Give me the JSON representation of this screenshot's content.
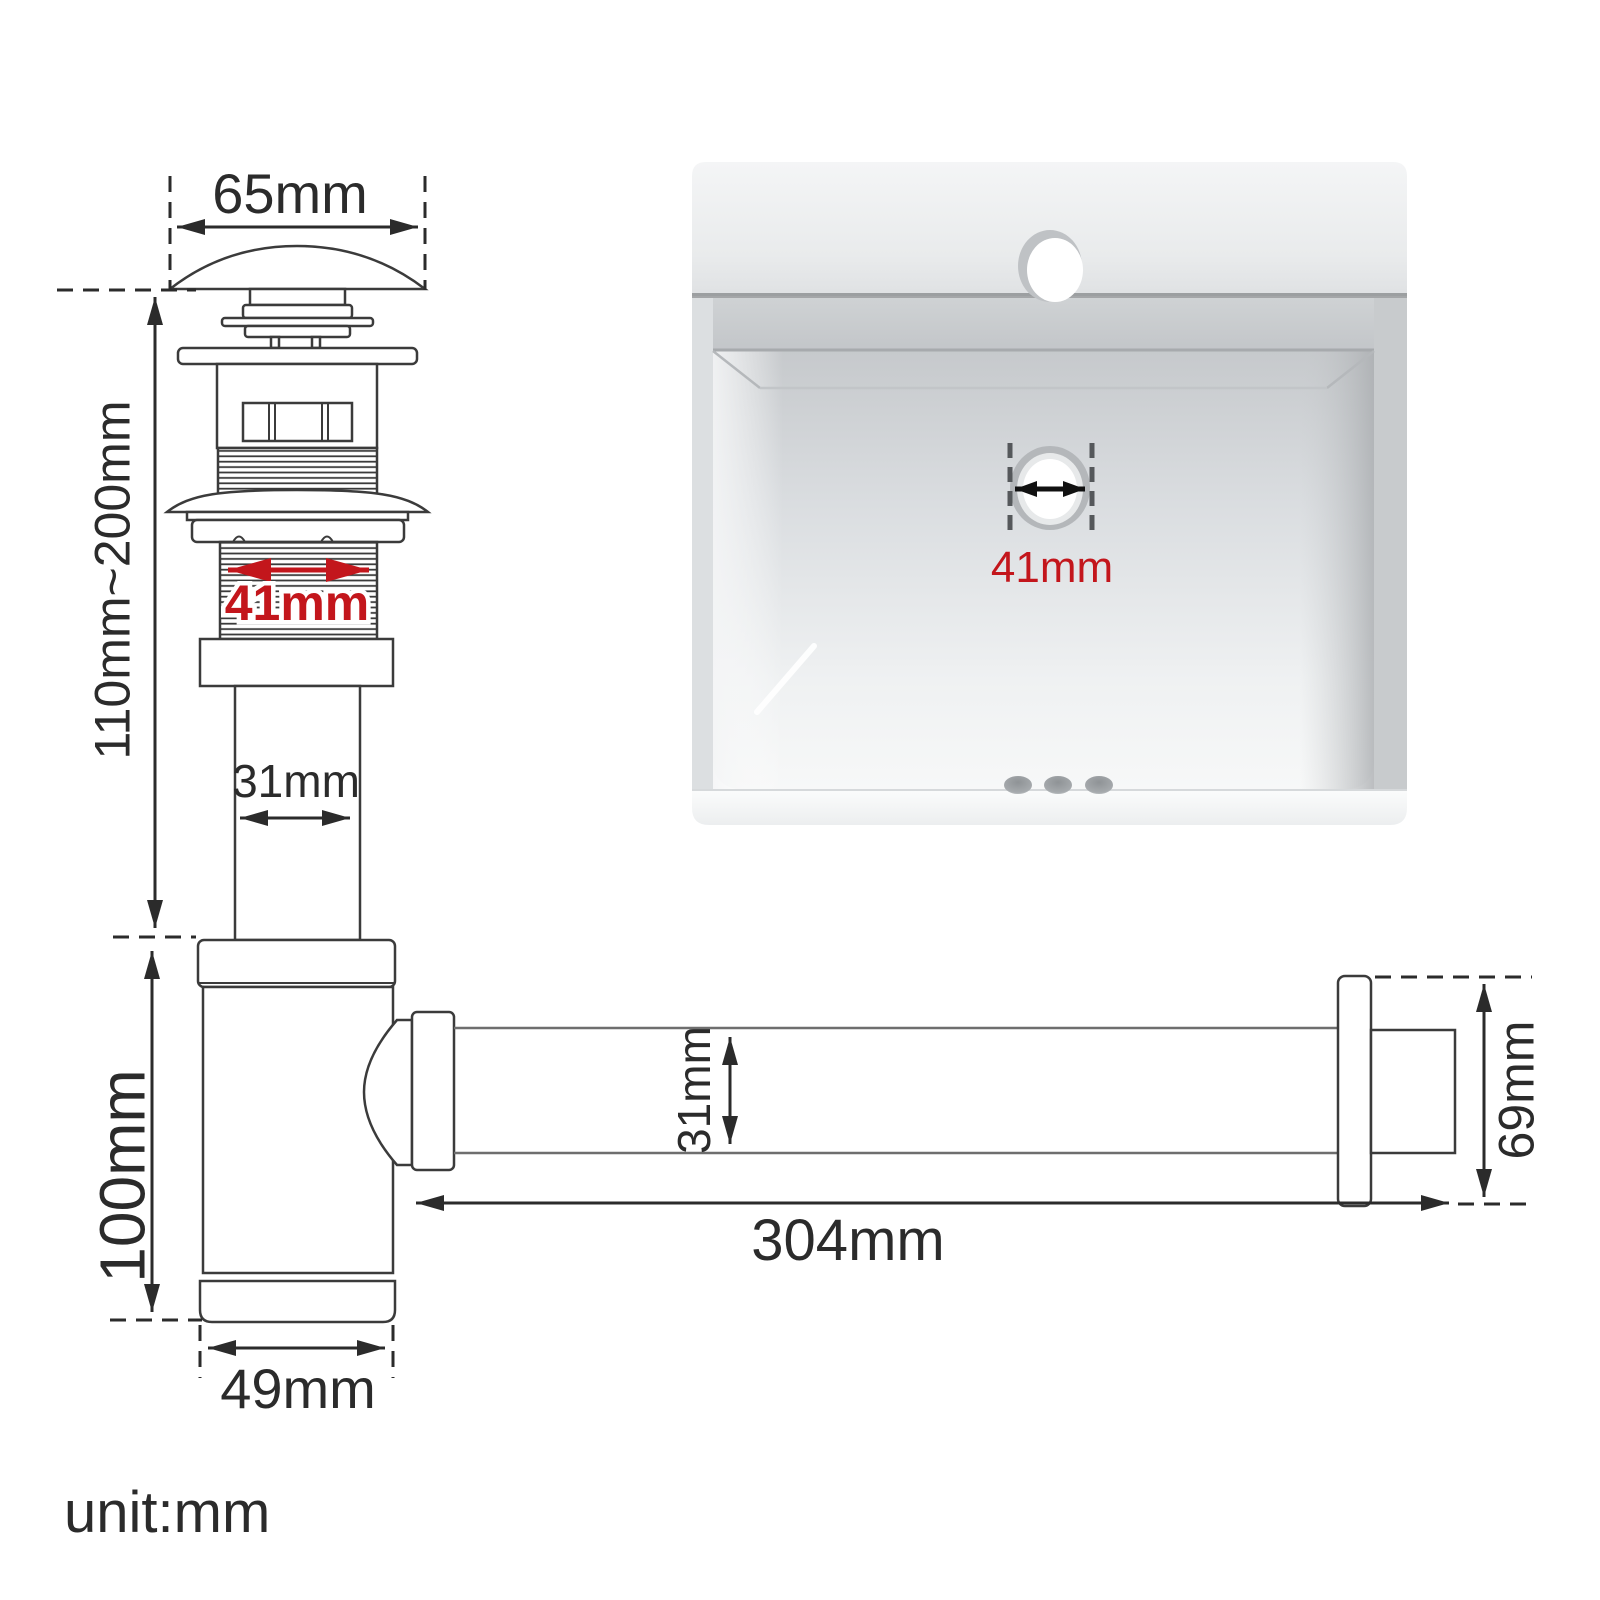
{
  "diagram": {
    "unit_note": "unit:mm",
    "popup_drain": {
      "cap_width": "65mm",
      "installed_height_range": "110mm~200mm",
      "thread_diameter": "41mm",
      "tailpipe_diameter": "31mm"
    },
    "bottle_trap": {
      "body_height": "100mm",
      "body_diameter": "49mm"
    },
    "outlet_pipe": {
      "diameter": "31mm",
      "length": "304mm",
      "wall_flange_height": "69mm"
    },
    "sink_photo": {
      "drain_hole_diameter": "41mm"
    },
    "colors": {
      "line": "#3b3b3b",
      "dimension_red": "#c3161c"
    }
  }
}
